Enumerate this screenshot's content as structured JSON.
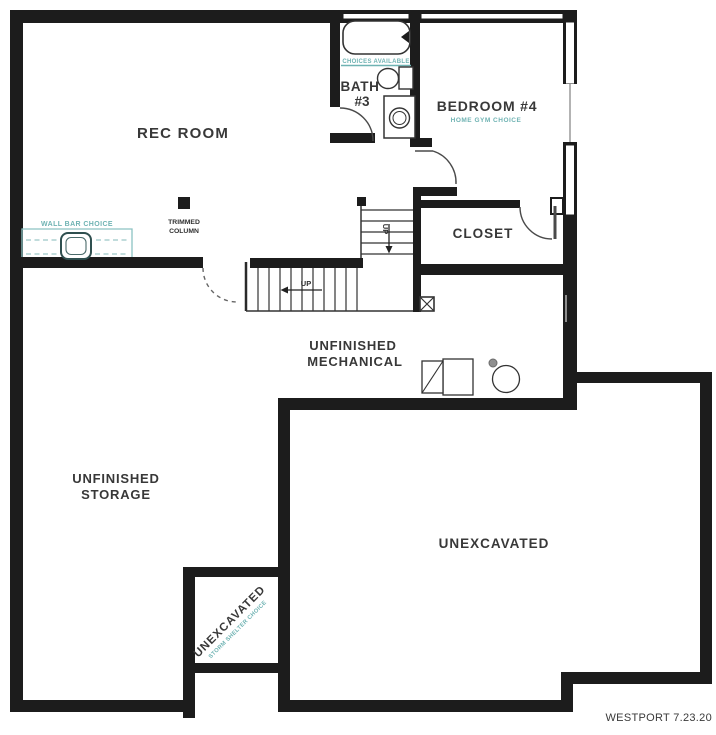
{
  "colors": {
    "wall": "#1c1c1c",
    "teal_accent": "#6fb3b3",
    "label_text": "#3a3a3a"
  },
  "rooms": {
    "rec_room": {
      "label": "REC ROOM"
    },
    "bath_3": {
      "line1": "BATH",
      "line2": "#3",
      "note": "CHOICES AVAILABLE"
    },
    "bedroom_4": {
      "label": "BEDROOM #4",
      "note": "HOME GYM CHOICE"
    },
    "closet": {
      "label": "CLOSET"
    },
    "unfinished_mechanical": {
      "line1": "UNFINISHED",
      "line2": "MECHANICAL"
    },
    "unfinished_storage": {
      "line1": "UNFINISHED",
      "line2": "STORAGE"
    },
    "unexcavated": {
      "label": "UNEXCAVATED"
    },
    "storm_shelter": {
      "label": "UNEXCAVATED",
      "note": "STORM SHELTER CHOICE"
    }
  },
  "annotations": {
    "wall_bar": {
      "label": "WALL BAR CHOICE"
    },
    "trimmed_column": {
      "line1": "TRIMMED",
      "line2": "COLUMN"
    },
    "stair_lower": {
      "label": "UP"
    },
    "stair_upper": {
      "label": "UP"
    }
  },
  "footer": {
    "plan_name_date": "WESTPORT 7.23.20"
  },
  "icons": {
    "bathtub-icon": "rounded-rect-with-faucet",
    "toilet-icon": "tank-rect-plus-bowl-ellipse",
    "washer-icon": "square-with-door-circle",
    "bar-sink-icon": "rounded-square-outline",
    "furnace-icon": "double-rect-with-diagonal",
    "water-heater-icon": "circle",
    "flue-icon": "small-filled-dot",
    "sump-pit-icon": "box-with-x",
    "column-icon": "small-filled-square"
  }
}
